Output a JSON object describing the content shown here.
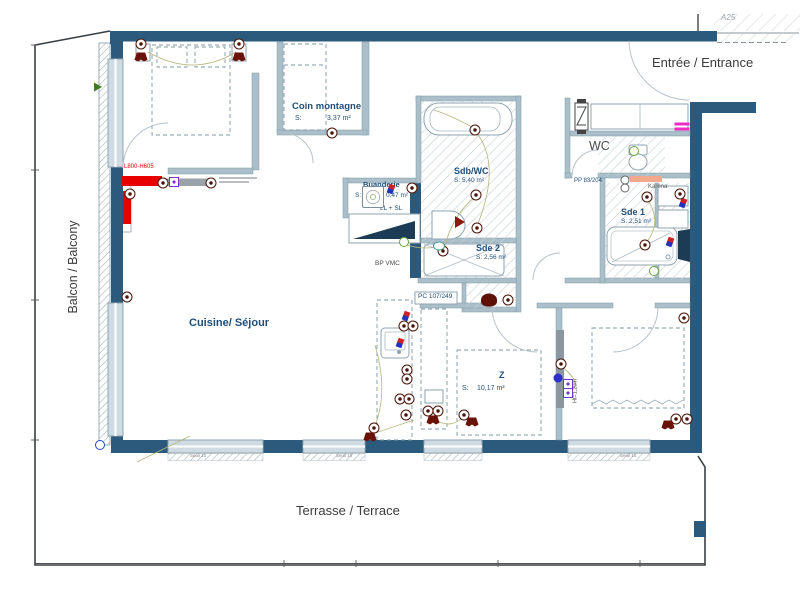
{
  "colors": {
    "wall": "#2b5a7d",
    "partition": "#aabfca",
    "hatch": "#c6cfd4",
    "accent_red": "#e80000",
    "symbol_darkred": "#4a1408",
    "magenta": "#ee2cc8",
    "green": "#69a83c",
    "purple": "#7436c8",
    "label_blue": "#1f4e79",
    "text_dark": "#3b3b3b"
  },
  "areas": {
    "entrance": "Entrée / Entrance",
    "balcony": "Balcon / Balcony",
    "terrace": "Terrasse / Terrace",
    "reference": "A25"
  },
  "rooms": {
    "kitchen_living": {
      "name": "Cuisine/ Séjour"
    },
    "coin_montagne": {
      "name": "Coin montagne",
      "s": "S:",
      "area": "3,37 m²"
    },
    "sdb_wc": {
      "name": "Sdb/WC",
      "area": "S: 5,40 m²"
    },
    "sde2": {
      "name": "Sde 2",
      "area": "S: 2,56 m²"
    },
    "sde1": {
      "name": "Sde 1",
      "area": "S: 2,51 m²"
    },
    "wc": {
      "name": "WC"
    },
    "buanderie": {
      "name": "Buanderie",
      "s": "S:",
      "area": "0,47 m²",
      "appliances": "LL + SL"
    },
    "bedroom": {
      "tag": "Z",
      "s": "S:",
      "area": "10,17 m²"
    }
  },
  "annotations": {
    "bp_vmc": "BP VMC",
    "pc_ref": "PC 107/249",
    "pp_ref": "PP 83/204",
    "radiator": "Karena",
    "tv_unit": "L800-H605",
    "window_height": "Ht=1,20m",
    "seuil": "Seuil 10"
  },
  "symbol_names": {
    "socket": "socket-symbol",
    "lamp": "wall-light-symbol",
    "tv": "tv-outlet-symbol",
    "ball": "sensor-symbol",
    "green": "spot-light-symbol",
    "teal": "spot-light-symbol",
    "valve": "valve-symbol",
    "washer": "washing-machine-symbol",
    "rb": "hot-cold-water-symbol",
    "blob": "wc-macerator-symbol",
    "wedge": "direction-arrow-symbol",
    "magenta": "highlight-mark",
    "bluedot": "drain-symbol",
    "garrow": "arrow-symbol"
  },
  "symbols": [
    {
      "t": "socket",
      "x": 141,
      "y": 44
    },
    {
      "t": "lamp",
      "x": 141,
      "y": 57
    },
    {
      "t": "socket",
      "x": 239,
      "y": 44
    },
    {
      "t": "lamp",
      "x": 239,
      "y": 57
    },
    {
      "t": "socket",
      "x": 332,
      "y": 133
    },
    {
      "t": "socket",
      "x": 127,
      "y": 297
    },
    {
      "t": "socket",
      "x": 163,
      "y": 183
    },
    {
      "t": "tv",
      "x": 174,
      "y": 182
    },
    {
      "t": "socket",
      "x": 211,
      "y": 183
    },
    {
      "t": "socket",
      "x": 130,
      "y": 194
    },
    {
      "t": "rb",
      "x": 391,
      "y": 189
    },
    {
      "t": "washer",
      "x": 373,
      "y": 197
    },
    {
      "t": "socket",
      "x": 412,
      "y": 188
    },
    {
      "t": "socket",
      "x": 475,
      "y": 130
    },
    {
      "t": "socket",
      "x": 476,
      "y": 195
    },
    {
      "t": "socket",
      "x": 477,
      "y": 228
    },
    {
      "t": "socket",
      "x": 443,
      "y": 251
    },
    {
      "t": "wedge",
      "x": 460,
      "y": 222
    },
    {
      "t": "green",
      "x": 404,
      "y": 242
    },
    {
      "t": "teal",
      "x": 439,
      "y": 246
    },
    {
      "t": "blob",
      "x": 489,
      "y": 300
    },
    {
      "t": "socket",
      "x": 508,
      "y": 300
    },
    {
      "t": "rb",
      "x": 406,
      "y": 316
    },
    {
      "t": "socket",
      "x": 404,
      "y": 326
    },
    {
      "t": "socket",
      "x": 413,
      "y": 326
    },
    {
      "t": "rb",
      "x": 400,
      "y": 343
    },
    {
      "t": "socket",
      "x": 407,
      "y": 370
    },
    {
      "t": "socket",
      "x": 407,
      "y": 379
    },
    {
      "t": "socket",
      "x": 400,
      "y": 399
    },
    {
      "t": "socket",
      "x": 409,
      "y": 399
    },
    {
      "t": "socket",
      "x": 406,
      "y": 415
    },
    {
      "t": "socket",
      "x": 374,
      "y": 428
    },
    {
      "t": "lamp",
      "x": 370,
      "y": 437
    },
    {
      "t": "socket",
      "x": 428,
      "y": 411
    },
    {
      "t": "socket",
      "x": 438,
      "y": 411
    },
    {
      "t": "lamp",
      "x": 433,
      "y": 420
    },
    {
      "t": "socket",
      "x": 464,
      "y": 415
    },
    {
      "t": "lamp",
      "x": 472,
      "y": 422
    },
    {
      "t": "socket",
      "x": 561,
      "y": 364
    },
    {
      "t": "ball",
      "x": 558,
      "y": 378
    },
    {
      "t": "tv",
      "x": 568,
      "y": 384
    },
    {
      "t": "tv",
      "x": 568,
      "y": 393
    },
    {
      "t": "socket",
      "x": 676,
      "y": 419
    },
    {
      "t": "socket",
      "x": 687,
      "y": 419
    },
    {
      "t": "lamp",
      "x": 668,
      "y": 425
    },
    {
      "t": "socket",
      "x": 684,
      "y": 318
    },
    {
      "t": "socket",
      "x": 647,
      "y": 197
    },
    {
      "t": "socket",
      "x": 645,
      "y": 245
    },
    {
      "t": "rb",
      "x": 670,
      "y": 242
    },
    {
      "t": "rb",
      "x": 683,
      "y": 203
    },
    {
      "t": "socket",
      "x": 680,
      "y": 194
    },
    {
      "t": "green",
      "x": 634,
      "y": 151
    },
    {
      "t": "green",
      "x": 654,
      "y": 271
    },
    {
      "t": "valve",
      "x": 625,
      "y": 180
    },
    {
      "t": "valve",
      "x": 625,
      "y": 188
    },
    {
      "t": "magenta",
      "x": 682,
      "y": 124
    },
    {
      "t": "magenta",
      "x": 682,
      "y": 129
    },
    {
      "t": "bluedot",
      "x": 100,
      "y": 445
    },
    {
      "t": "garrow",
      "x": 98,
      "y": 87
    }
  ]
}
